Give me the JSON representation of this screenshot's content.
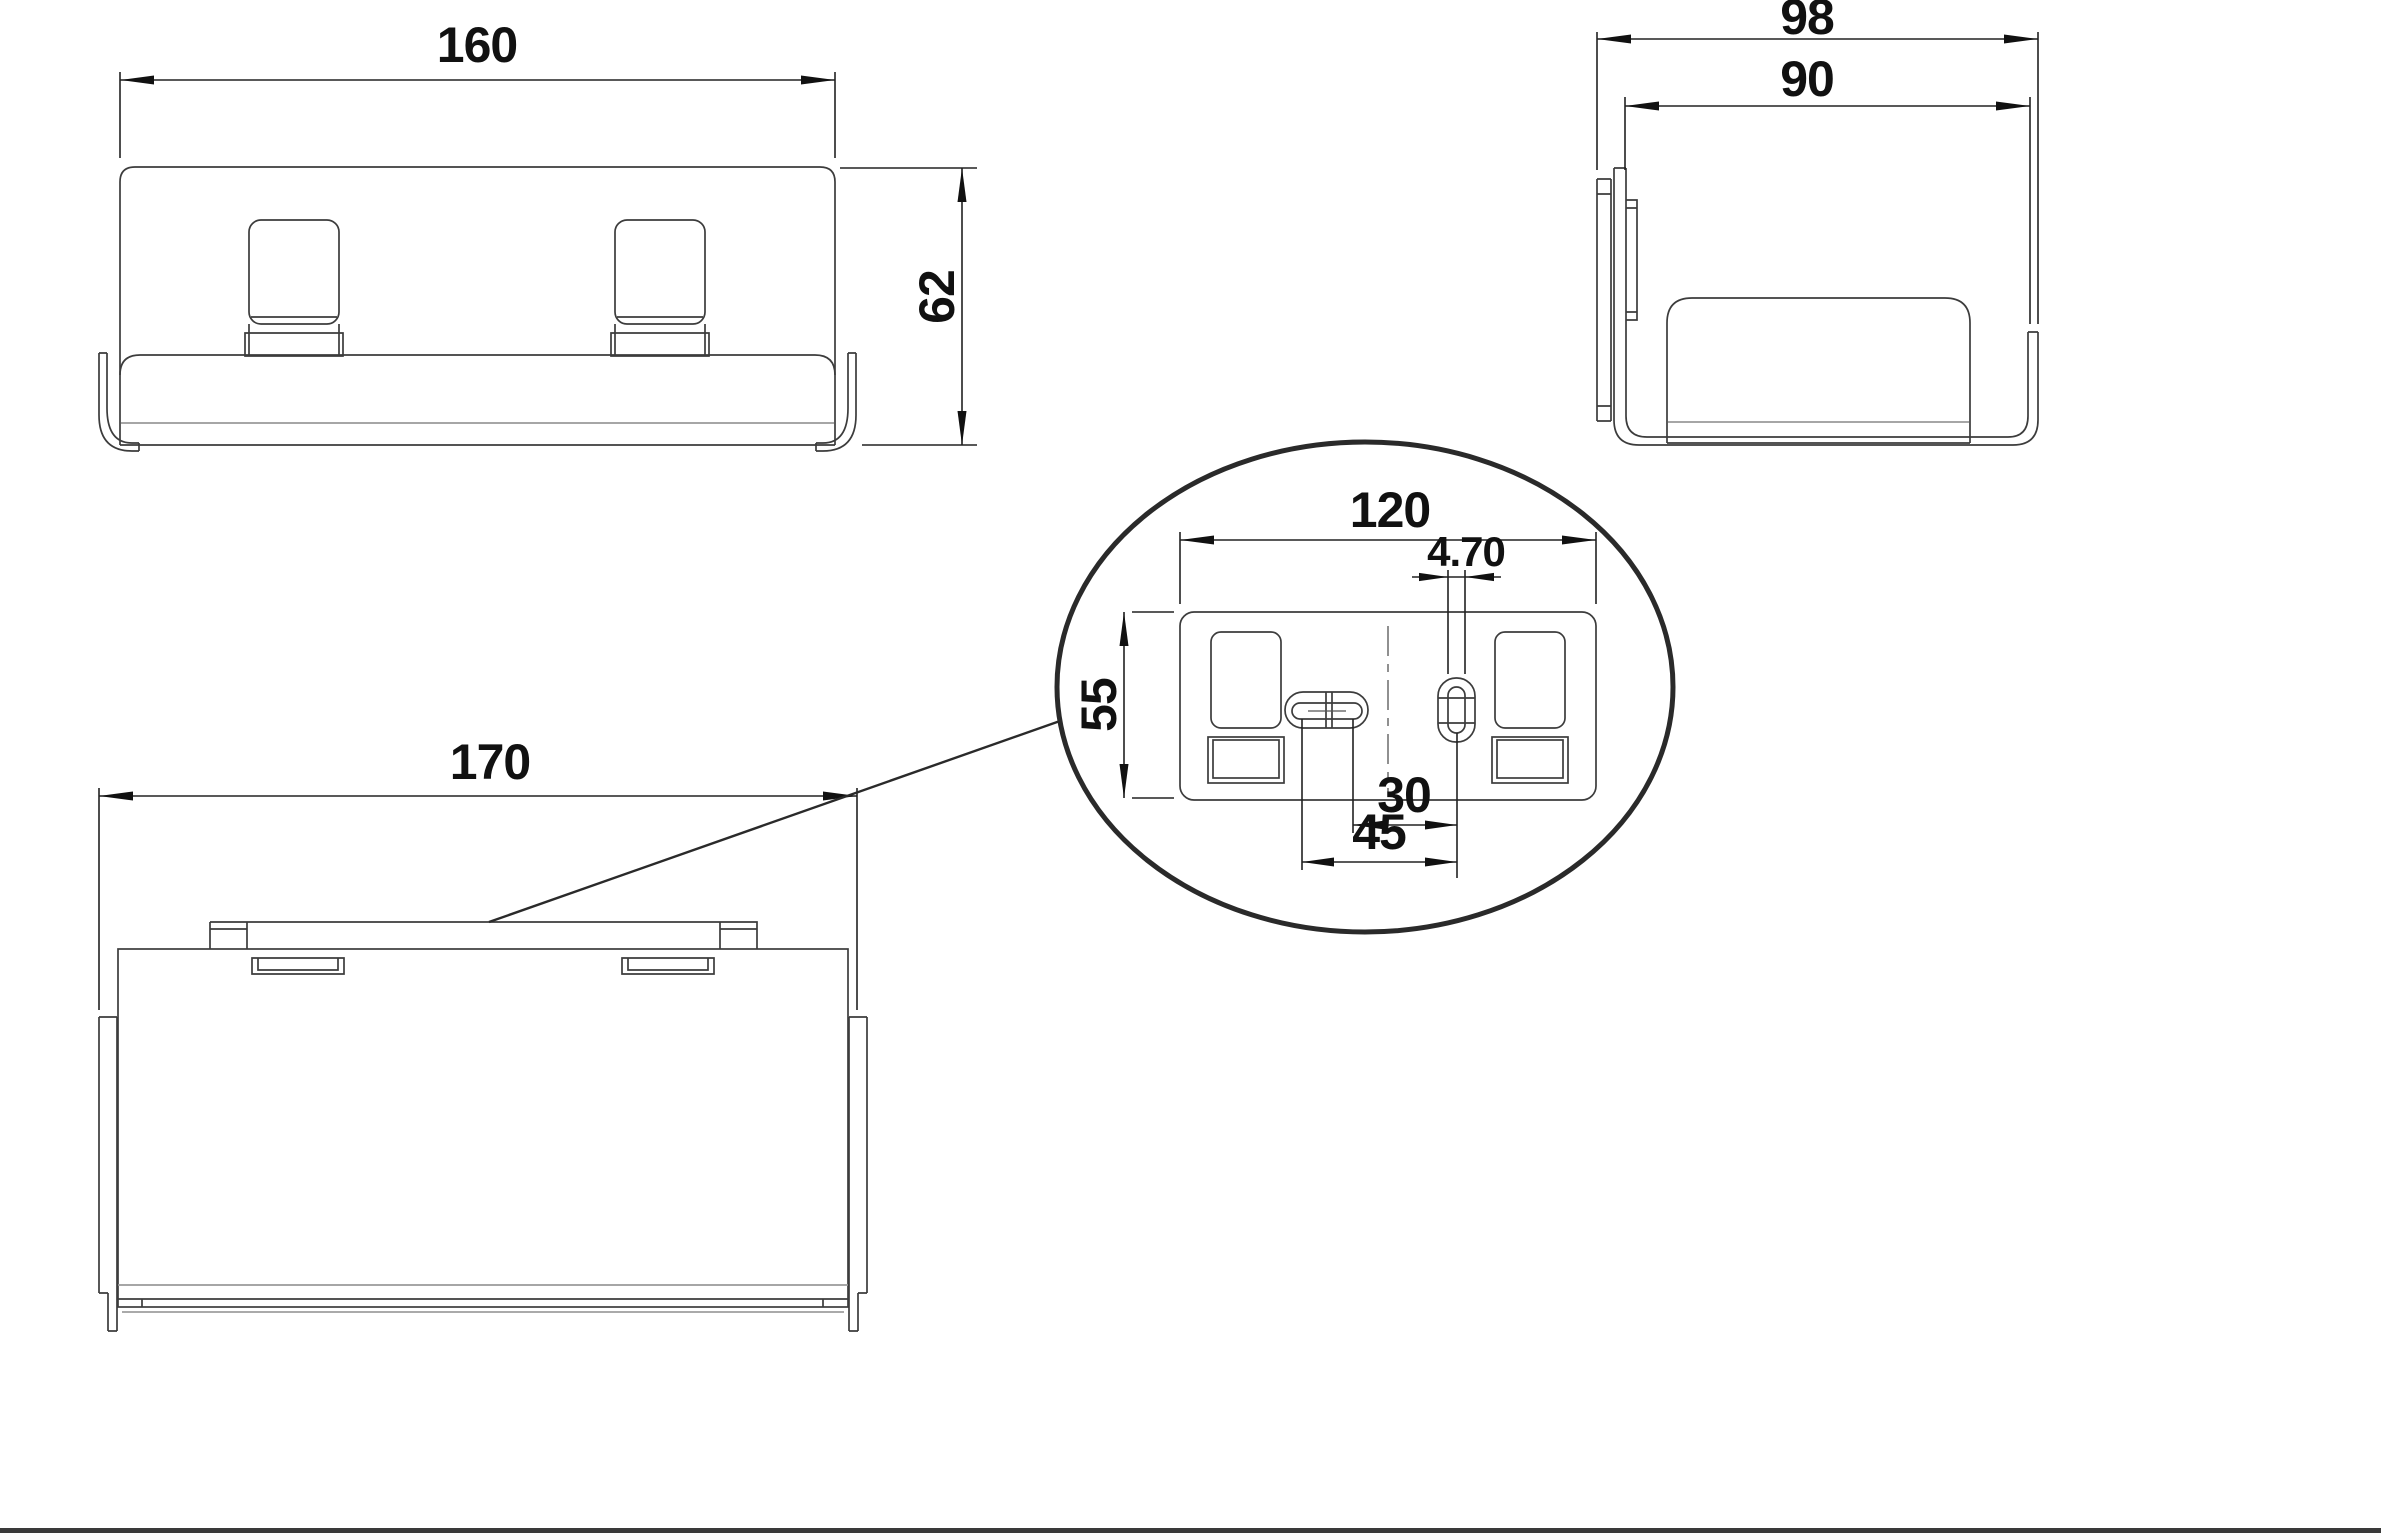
{
  "drawing": {
    "type": "technical-multiview-drawing",
    "dims": {
      "front_width": "160",
      "front_height": "62",
      "side_depth": "98",
      "side_opening": "90",
      "top_width": "170",
      "detail_plate_width": "120",
      "detail_plate_height": "55",
      "detail_slot_width": "4.70",
      "detail_hole_spacing": "30",
      "detail_slot_spacing": "45"
    },
    "colors": {
      "line": "#3c3c3c",
      "dim_line": "#222222",
      "thin_line": "#9a9a9a",
      "detail_circle": "#2a2a2a",
      "sheet_border": "#3a3a3a",
      "background": "#ffffff"
    }
  }
}
